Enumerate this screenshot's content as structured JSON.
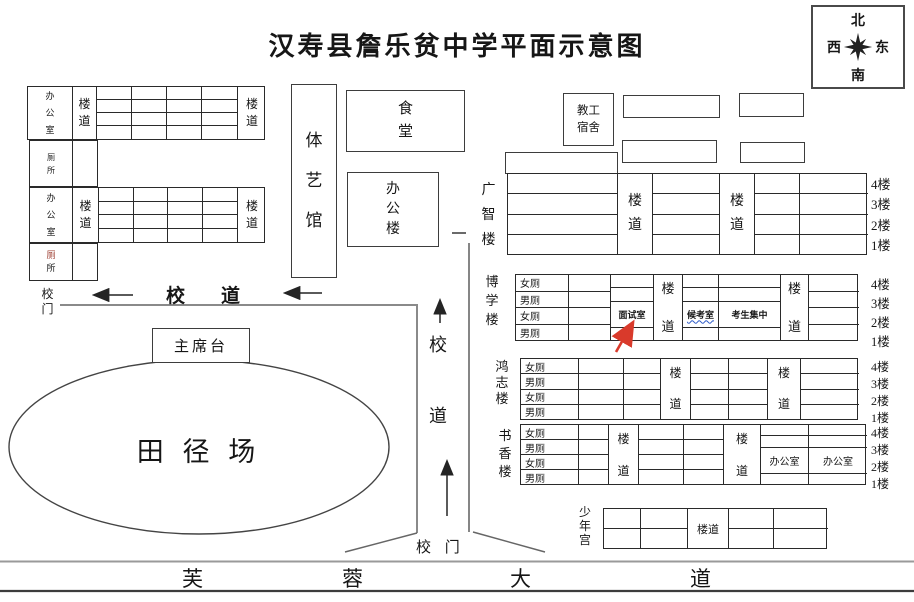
{
  "title": "汉寿县詹乐贫中学平面示意图",
  "compass": {
    "north": "北",
    "west": "西",
    "east": "东",
    "south": "南"
  },
  "floors": [
    "4楼",
    "3楼",
    "2楼",
    "1楼"
  ],
  "wc": [
    "女厕",
    "男厕",
    "女厕",
    "男厕"
  ],
  "left_area": {
    "block1_room": "办公室",
    "block1_corridor_left": "楼道",
    "block1_corridor_right": "楼道",
    "toilet1": "厕所",
    "block2_room": "办公室",
    "block2_corridor_left": "楼道",
    "block2_corridor_right": "楼道",
    "toilet2_char1": "厕",
    "toilet2_char2": "所",
    "gate": "校门"
  },
  "roads": {
    "campus_road_h": "校道",
    "campus_road_v_char1": "校",
    "campus_road_v_char2": "道",
    "gate_bottom": "校 门",
    "avenue": [
      "芙",
      "蓉",
      "大",
      "道"
    ]
  },
  "buildings": {
    "gym": "体艺馆",
    "canteen": "食堂",
    "office_building": "办公楼",
    "staff_dorm": "教工宿舍",
    "guangzhi": {
      "name": "广智楼",
      "corridor": "楼道"
    },
    "boxue": {
      "name": "博学楼",
      "corridor": "楼道",
      "interview_room": "面试室",
      "waiting_room": "候考室",
      "gathering": "考生集中"
    },
    "hongzhi": {
      "name": "鸿志楼",
      "corridor": "楼道"
    },
    "shuxiang": {
      "name": "书香楼",
      "corridor": "楼道",
      "office1": "办公室",
      "office2": "办公室"
    },
    "youth_palace": {
      "name": "少年宫",
      "corridor": "楼道"
    }
  },
  "field": {
    "track": "田 径 场",
    "rostrum": "主席台"
  },
  "colors": {
    "red_arrow": "#d93a2b",
    "underline_blue": "#2b59c6",
    "toilet_red": "#9c3b2e",
    "line_dark": "#3d3d3d",
    "road_gray": "#8a8a8a"
  }
}
